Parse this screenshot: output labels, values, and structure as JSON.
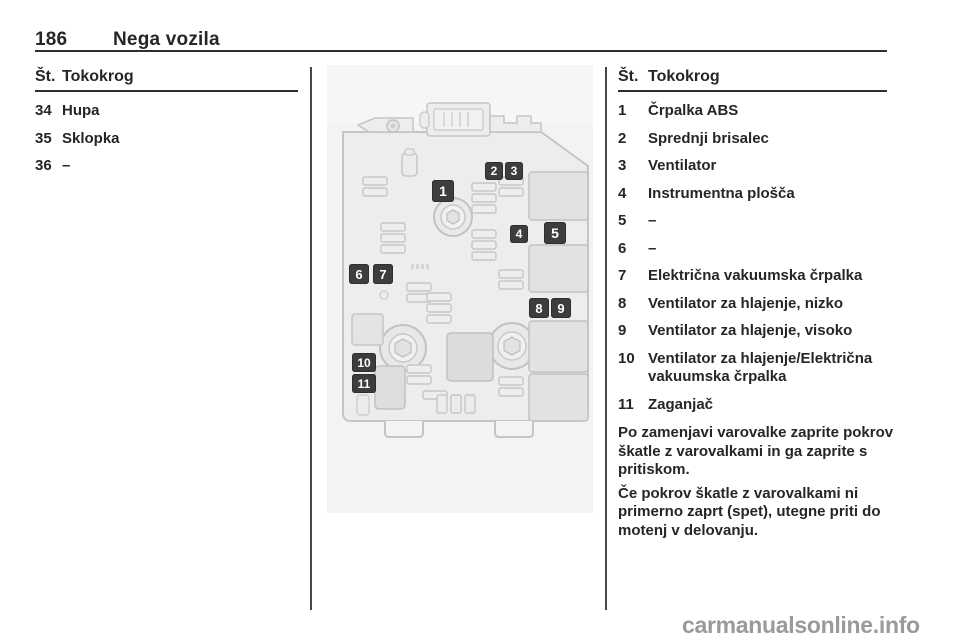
{
  "header": {
    "page_number": "186",
    "chapter_title": "Nega vozila"
  },
  "left_table": {
    "header_no": "Št.",
    "header_circuit": "Tokokrog",
    "rows": [
      {
        "no": "34",
        "circuit": "Hupa"
      },
      {
        "no": "35",
        "circuit": "Sklopka"
      },
      {
        "no": "36",
        "circuit": "–"
      }
    ]
  },
  "right_table": {
    "header_no": "Št.",
    "header_circuit": "Tokokrog",
    "rows": [
      {
        "no": "1",
        "circuit": "Črpalka ABS"
      },
      {
        "no": "2",
        "circuit": "Sprednji brisalec"
      },
      {
        "no": "3",
        "circuit": "Ventilator"
      },
      {
        "no": "4",
        "circuit": "Instrumentna plošča"
      },
      {
        "no": "5",
        "circuit": "–"
      },
      {
        "no": "6",
        "circuit": "–"
      },
      {
        "no": "7",
        "circuit": "Električna vakuumska črpalka"
      },
      {
        "no": "8",
        "circuit": "Ventilator za hlajenje, nizko"
      },
      {
        "no": "9",
        "circuit": "Ventilator za hlajenje, visoko"
      },
      {
        "no": "10",
        "circuit": "Ventilator za hlajenje/Električna vakuumska črpalka"
      },
      {
        "no": "11",
        "circuit": "Zaganjač"
      }
    ]
  },
  "notes": {
    "paragraph_1": "Po zamenjavi varovalke zaprite pokrov škatle z varovalkami in ga zaprite s pritiskom.",
    "paragraph_2": "Če pokrov škatle z varovalkami ni primerno zaprt (spet), utegne priti do motenj v delovanju."
  },
  "diagram": {
    "labels": [
      "1",
      "2",
      "3",
      "4",
      "5",
      "6",
      "7",
      "8",
      "9",
      "10",
      "11"
    ]
  },
  "watermark": "carmanualsonline.info",
  "colors": {
    "text": "#262626",
    "rule": "#2e2e2e",
    "label_bg": "#3d3d3d",
    "image_bg": "#f3f3f3",
    "watermark": "#9a9a9a"
  }
}
